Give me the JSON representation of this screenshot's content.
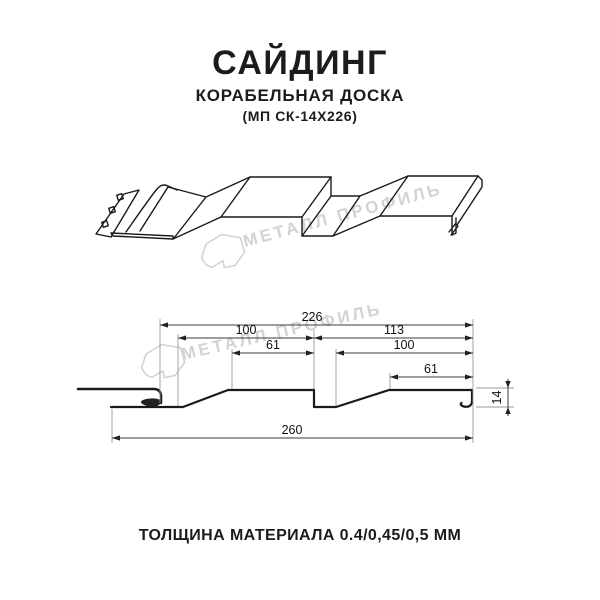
{
  "title": {
    "main": "САЙДИНГ",
    "subtitle": "КОРАБЕЛЬНАЯ ДОСКА",
    "code": "(МП СК-14Х226)"
  },
  "watermark": {
    "text": "МЕТАЛЛ ПРОФИЛЬ",
    "color": "#d3d3d3"
  },
  "cross_section": {
    "dimensions": {
      "overall": "226",
      "left_board_pitch": "100",
      "right_board_pitch": "113",
      "left_board_flat": "61",
      "right_board_inner": "100",
      "right_board_flat": "61",
      "total_width": "260",
      "profile_height": "14"
    }
  },
  "footer": {
    "thickness_note": "ТОЛЩИНА МАТЕРИАЛА 0.4/0,45/0,5 ММ"
  },
  "colors": {
    "line": "#1a1a1a",
    "dimension": "#3a3a3a",
    "extension": "#9a9a9a"
  }
}
